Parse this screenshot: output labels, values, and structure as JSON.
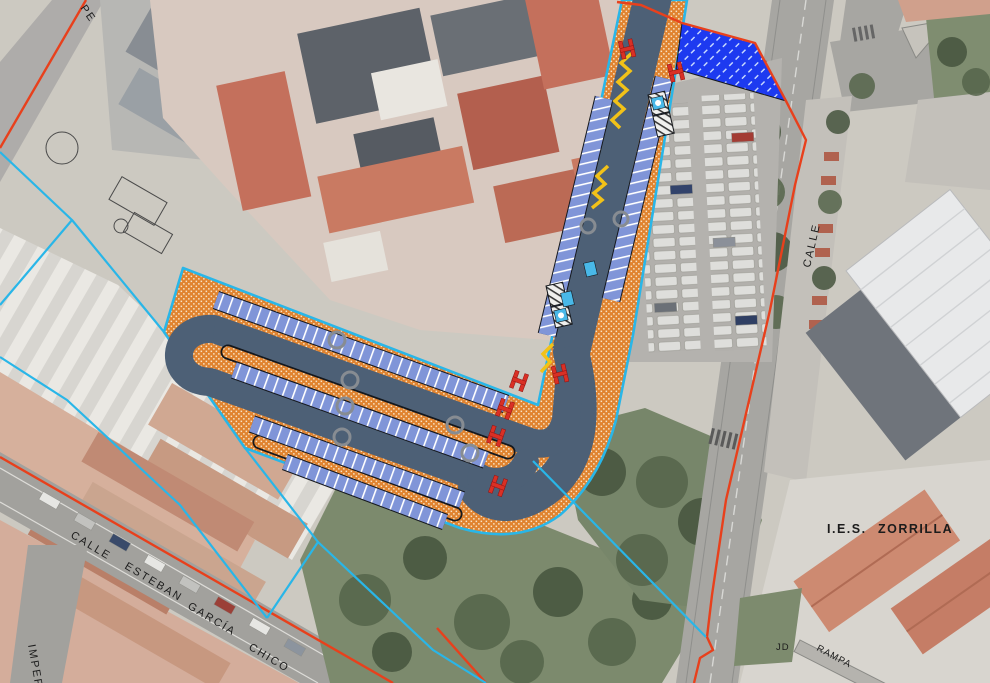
{
  "map": {
    "labels": {
      "pe": "PE",
      "calle_right": "CALLE",
      "calle_bl": "CALLE",
      "esteban": "ESTEBAN",
      "garcia": "GARCÍA",
      "chico": "CHICO",
      "imperial": "IMPER",
      "ies": "I.E.S.",
      "zorrilla": "ZORRILLA",
      "jd": "JD",
      "rampa": "RAMPA"
    }
  },
  "overlay": {
    "description": "Urban redevelopment plan overlaid on aerial photo: boulevard with parking loops",
    "features": {
      "roadway": "planned carriageway loop",
      "sidewalk": "orange paved sidewalk / median islands",
      "parking_stalls": "rows of striped parking bays",
      "reserved_zone": "blue hatched reserved area",
      "crossings": "red pedestrian crossing markers",
      "yield_zigzag": "yellow zigzag road marking",
      "boundary_outer": "red-orange study area limit",
      "boundary_parcel": "cyan parcel / actuation limit"
    }
  },
  "colors": {
    "road": "#4d6076",
    "orange": "#e0832f",
    "orange_dot": "#f7e3c8",
    "stall": "#8095d8",
    "stall_line": "#ffffff",
    "reserved": "#1d3af0",
    "reserved_line": "#cfe0ff",
    "cyan": "#29b6e8",
    "red": "#e8401c",
    "marker": "#d93025",
    "yellow": "#f2c218",
    "icon_blue": "#49b8e8"
  }
}
